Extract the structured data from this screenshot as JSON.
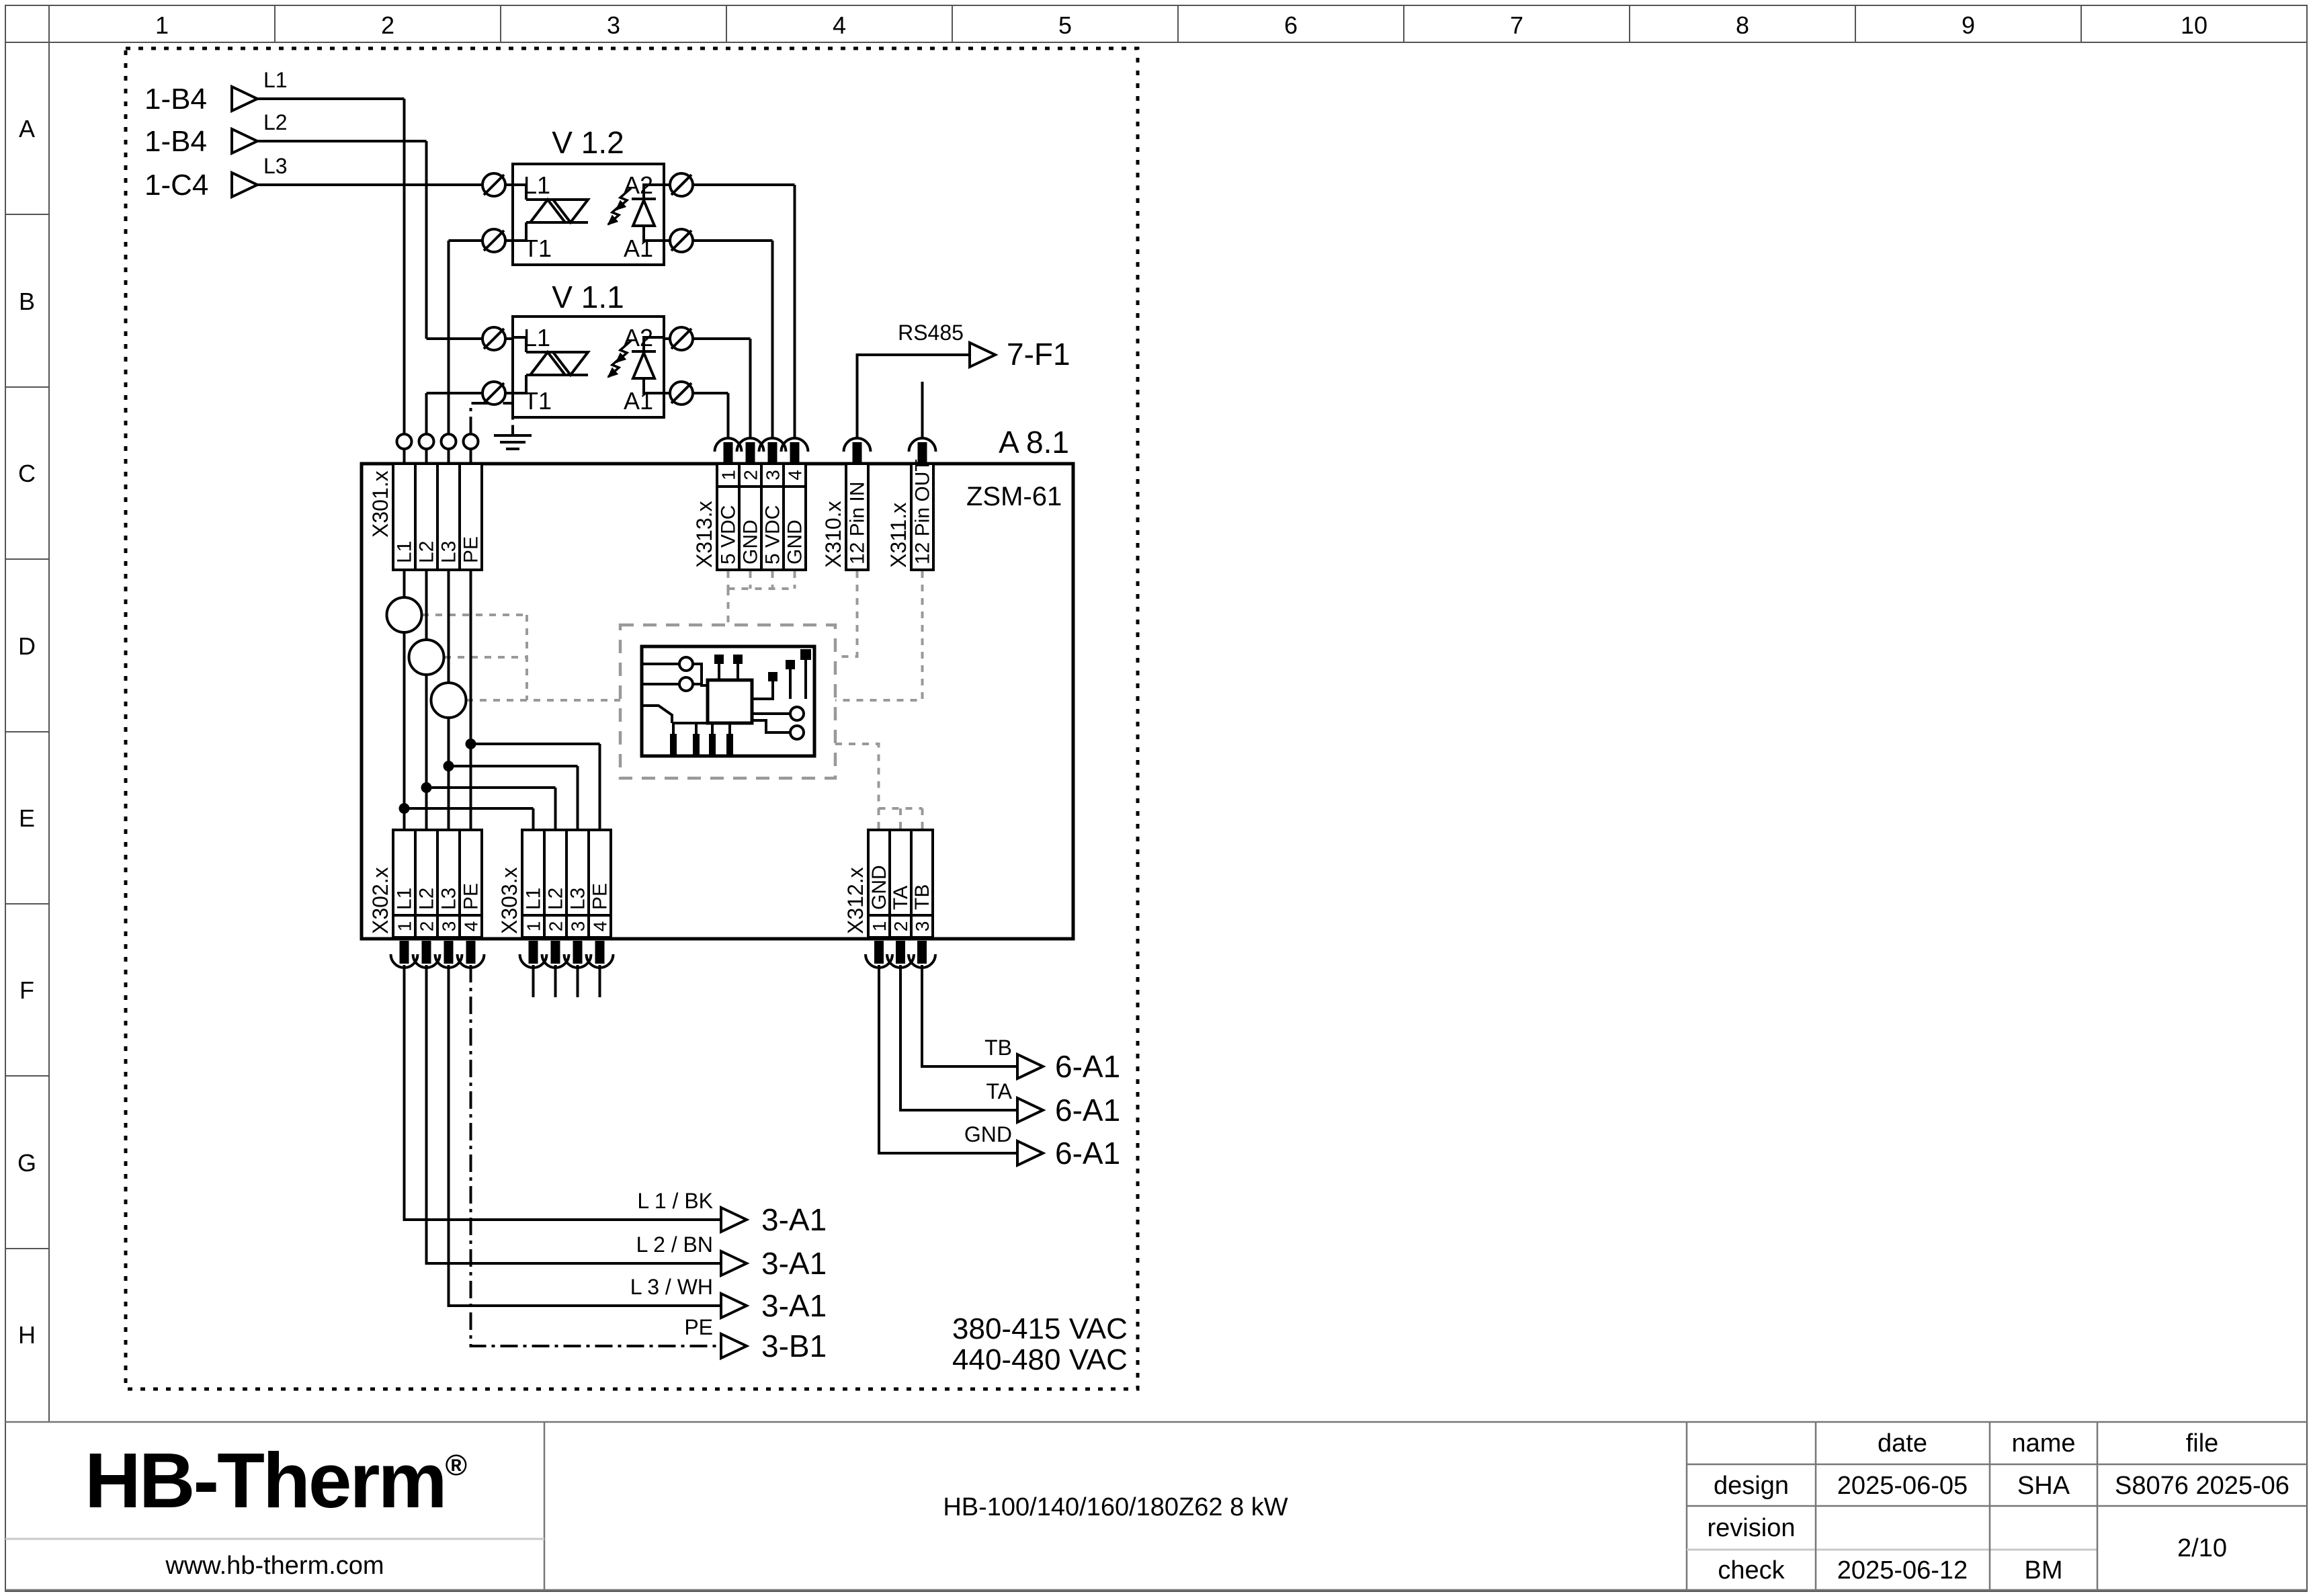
{
  "grid": {
    "cols": [
      "1",
      "2",
      "3",
      "4",
      "5",
      "6",
      "7",
      "8",
      "9",
      "10"
    ],
    "rows": [
      "A",
      "B",
      "C",
      "D",
      "E",
      "F",
      "G",
      "H"
    ]
  },
  "inputs": [
    {
      "ref": "1-B4",
      "line": "L1"
    },
    {
      "ref": "1-B4",
      "line": "L2"
    },
    {
      "ref": "1-C4",
      "line": "L3"
    }
  ],
  "triacs": [
    {
      "name": "V 1.2"
    },
    {
      "name": "V 1.1"
    }
  ],
  "triac_pins": {
    "tl": "L1",
    "tr": "A2",
    "bl": "T1",
    "br": "A1"
  },
  "block": {
    "ref": "A 8.1",
    "model": "ZSM-61"
  },
  "terminals": {
    "x301": {
      "name": "X301.x",
      "cells": [
        "L1",
        "L2",
        "L3",
        "PE"
      ]
    },
    "x313": {
      "name": "X313.x",
      "pins": [
        "1",
        "2",
        "3",
        "4"
      ],
      "cells": [
        "5 VDC",
        "GND",
        "5 VDC",
        "GND"
      ]
    },
    "x310": {
      "name": "X310.x",
      "cells": [
        "12 Pin IN"
      ]
    },
    "x311": {
      "name": "X311.x",
      "cells": [
        "12 Pin OUT"
      ]
    },
    "x302": {
      "name": "X302.x",
      "pins": [
        "1",
        "2",
        "3",
        "4"
      ],
      "cells": [
        "L1",
        "L2",
        "L3",
        "PE"
      ]
    },
    "x303": {
      "name": "X303.x",
      "pins": [
        "1",
        "2",
        "3",
        "4"
      ],
      "cells": [
        "L1",
        "L2",
        "L3",
        "PE"
      ]
    },
    "x312": {
      "name": "X312.x",
      "pins": [
        "1",
        "2",
        "3"
      ],
      "cells": [
        "GND",
        "TA",
        "TB"
      ]
    }
  },
  "rs485": {
    "label": "RS485",
    "target": "7-F1"
  },
  "comm": [
    {
      "label": "TB",
      "target": "6-A1"
    },
    {
      "label": "TA",
      "target": "6-A1"
    },
    {
      "label": "GND",
      "target": "6-A1"
    }
  ],
  "power": [
    {
      "label": "L 1 / BK",
      "target": "3-A1"
    },
    {
      "label": "L 2 / BN",
      "target": "3-A1"
    },
    {
      "label": "L 3 / WH",
      "target": "3-A1"
    },
    {
      "label": "PE",
      "target": "3-B1"
    }
  ],
  "voltage": [
    "380-415 VAC",
    "440-480 VAC"
  ],
  "titleblock": {
    "logo": "HB-Therm",
    "registered": "®",
    "website": "www.hb-therm.com",
    "doc_title": "HB-100/140/160/180Z62 8 kW",
    "headers": {
      "date": "date",
      "name": "name",
      "file": "file"
    },
    "design": {
      "label": "design",
      "date": "2025-06-05",
      "name": "SHA",
      "file": "S8076 2025-06"
    },
    "revision": {
      "label": "revision"
    },
    "check": {
      "label": "check",
      "date": "2025-06-12",
      "name": "BM"
    },
    "page": "2/10"
  },
  "colors": {
    "logo": "#16254e",
    "dash": "#999999"
  }
}
